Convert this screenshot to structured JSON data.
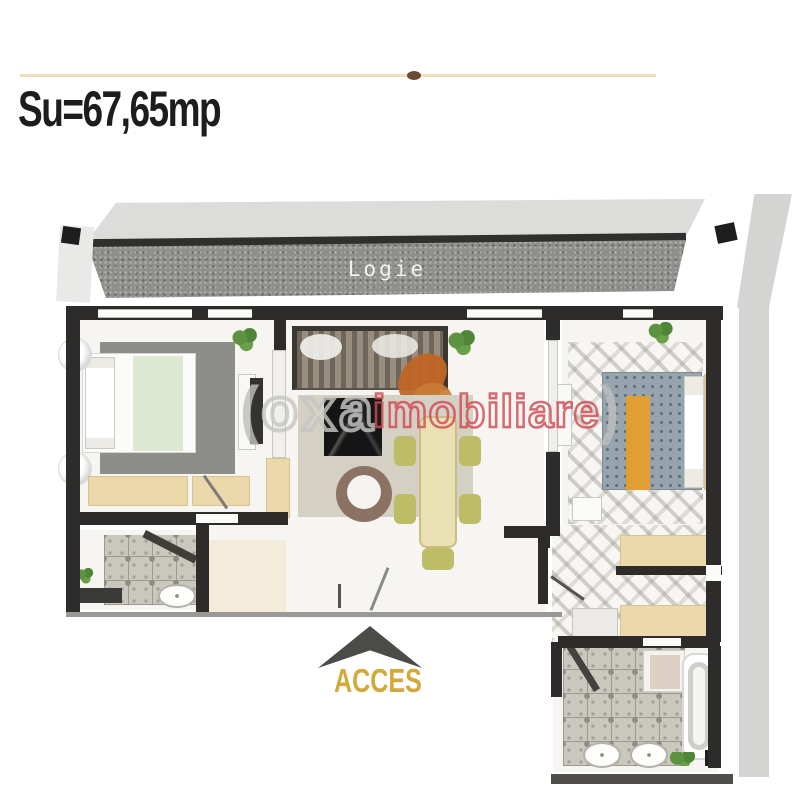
{
  "header": {
    "area_label": "Su=67,65mp"
  },
  "balcony": {
    "label": "Logie"
  },
  "entrance": {
    "label": "ACCES"
  },
  "watermark": {
    "bracket_open": "(",
    "brand": "oxa",
    "name": "imobiliare",
    "bracket_close": ")"
  },
  "colors": {
    "accent_line": "#efe0bb",
    "title_text": "#1f1d1b",
    "balcony_face": "#8f8f8b",
    "balcony_roof": "#dcdcda",
    "balcony_label_text": "#f2f2ef",
    "wall": "#2e2c2a",
    "exterior_band": "#d4d4d2",
    "access_text": "#d2a93a",
    "access_arrow": "#4b4b47",
    "watermark_brand": "#c6c6c4",
    "watermark_name": "#d14c55",
    "wood_furniture": "#ecd9ab",
    "dining_chair": "#bdbd68",
    "plant": "#5d9340",
    "orange_accent": "#bf6526",
    "bed_runner_orange": "#e19f33",
    "blanket_gray_blue": "#97a4ad",
    "left_rug": "#8d8d8a",
    "living_rug": "#d4d0c4",
    "tile_floor": "#cac7be",
    "floor_white": "#f6f5f1"
  }
}
